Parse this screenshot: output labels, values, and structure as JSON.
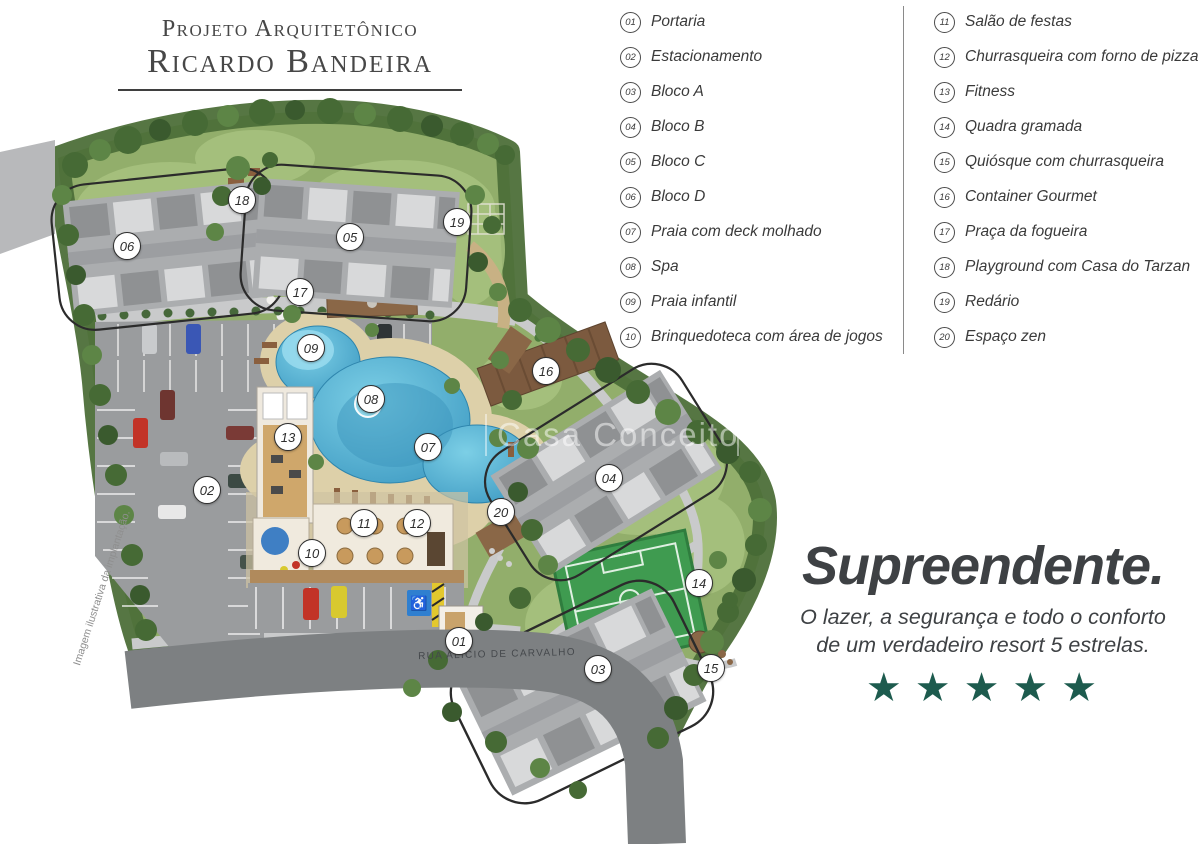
{
  "header": {
    "line1": "Projeto Arquitetônico",
    "line2": "Ricardo Bandeira"
  },
  "legend": {
    "col1": [
      {
        "num": "01",
        "label": "Portaria"
      },
      {
        "num": "02",
        "label": "Estacionamento"
      },
      {
        "num": "03",
        "label": "Bloco A"
      },
      {
        "num": "04",
        "label": "Bloco B"
      },
      {
        "num": "05",
        "label": "Bloco C"
      },
      {
        "num": "06",
        "label": "Bloco D"
      },
      {
        "num": "07",
        "label": "Praia com deck molhado"
      },
      {
        "num": "08",
        "label": "Spa"
      },
      {
        "num": "09",
        "label": "Praia infantil"
      },
      {
        "num": "10",
        "label": "Brinquedoteca com área de jogos"
      }
    ],
    "col2": [
      {
        "num": "11",
        "label": "Salão de festas"
      },
      {
        "num": "12",
        "label": "Churrasqueira com forno de pizza"
      },
      {
        "num": "13",
        "label": "Fitness"
      },
      {
        "num": "14",
        "label": "Quadra gramada"
      },
      {
        "num": "15",
        "label": "Quiósque com churrasqueira"
      },
      {
        "num": "16",
        "label": "Container Gourmet"
      },
      {
        "num": "17",
        "label": "Praça da fogueira"
      },
      {
        "num": "18",
        "label": "Playground com Casa do Tarzan"
      },
      {
        "num": "19",
        "label": "Redário"
      },
      {
        "num": "20",
        "label": "Espaço zen"
      }
    ]
  },
  "map": {
    "road_label": "RUA ALICIO DE CARVALHO",
    "watermark": "Casa Conceito",
    "disclaimer": "Imagem ilustrativa da implantação.",
    "markers": [
      {
        "num": "01",
        "x": 459,
        "y": 641
      },
      {
        "num": "02",
        "x": 207,
        "y": 490
      },
      {
        "num": "03",
        "x": 598,
        "y": 669
      },
      {
        "num": "04",
        "x": 609,
        "y": 478
      },
      {
        "num": "05",
        "x": 350,
        "y": 237
      },
      {
        "num": "06",
        "x": 127,
        "y": 246
      },
      {
        "num": "07",
        "x": 428,
        "y": 447
      },
      {
        "num": "08",
        "x": 371,
        "y": 399
      },
      {
        "num": "09",
        "x": 311,
        "y": 348
      },
      {
        "num": "10",
        "x": 312,
        "y": 553
      },
      {
        "num": "11",
        "x": 364,
        "y": 523
      },
      {
        "num": "12",
        "x": 417,
        "y": 523
      },
      {
        "num": "13",
        "x": 288,
        "y": 437
      },
      {
        "num": "14",
        "x": 699,
        "y": 583
      },
      {
        "num": "15",
        "x": 711,
        "y": 668
      },
      {
        "num": "16",
        "x": 546,
        "y": 371
      },
      {
        "num": "17",
        "x": 300,
        "y": 292
      },
      {
        "num": "18",
        "x": 242,
        "y": 200
      },
      {
        "num": "19",
        "x": 457,
        "y": 222
      },
      {
        "num": "20",
        "x": 501,
        "y": 512
      }
    ]
  },
  "tagline": {
    "headline": "Supreendente.",
    "line1": "O lazer, a segurança e todo o conforto",
    "line2": "de um verdadeiro resort 5 estrelas.",
    "stars": "★★★★★",
    "star_color": "#1d5b4e"
  }
}
